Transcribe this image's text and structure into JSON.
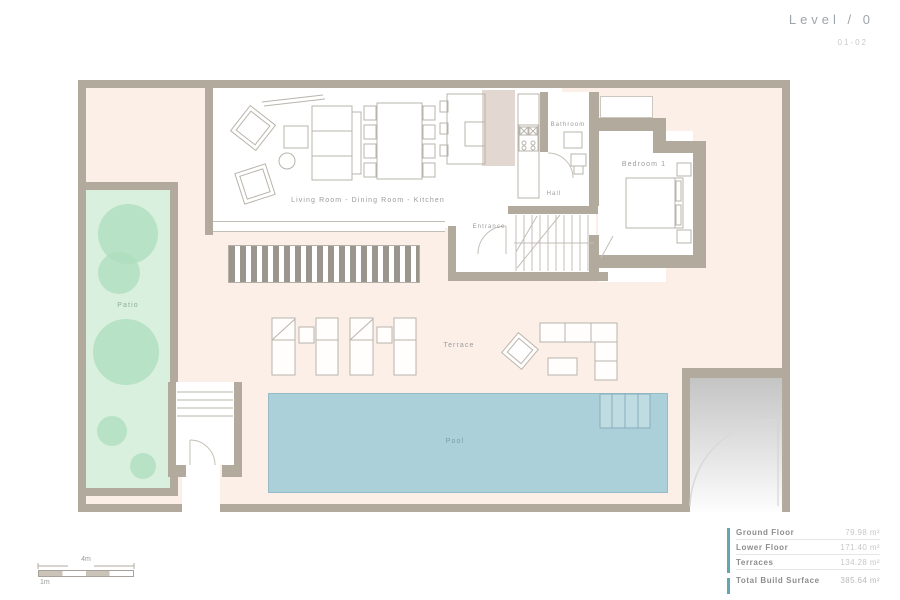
{
  "header": {
    "title": "Level / 0",
    "sheet": "01-02"
  },
  "plan": {
    "rooms": {
      "living": "Living Room - Dining Room - Kitchen",
      "bathroom": "Bathroom",
      "bedroom": "Bedroom 1",
      "hall": "Hall",
      "entrance": "Entrance",
      "terrace": "Terrace",
      "pool": "Pool",
      "patio": "Patio"
    }
  },
  "scale_bar": {
    "total": "4m",
    "unit": "1m"
  },
  "area_table": {
    "rows": [
      {
        "label": "Ground Floor",
        "value": "79.98 m²"
      },
      {
        "label": "Lower Floor",
        "value": "171.40 m²"
      },
      {
        "label": "Terraces",
        "value": "134.28 m²"
      }
    ],
    "total": {
      "label": "Total Build Surface",
      "value": "385.64 m²"
    }
  },
  "colors": {
    "wall": "#b2aa9c",
    "plot_interior": "#fcefe8",
    "patio": "#d9f0de",
    "tree": "#aedfbe",
    "pool": "#abd0da",
    "accent_teal": "#5fa8b0",
    "line": "#b9b4ab",
    "label_gray": "#9b9b9b"
  }
}
